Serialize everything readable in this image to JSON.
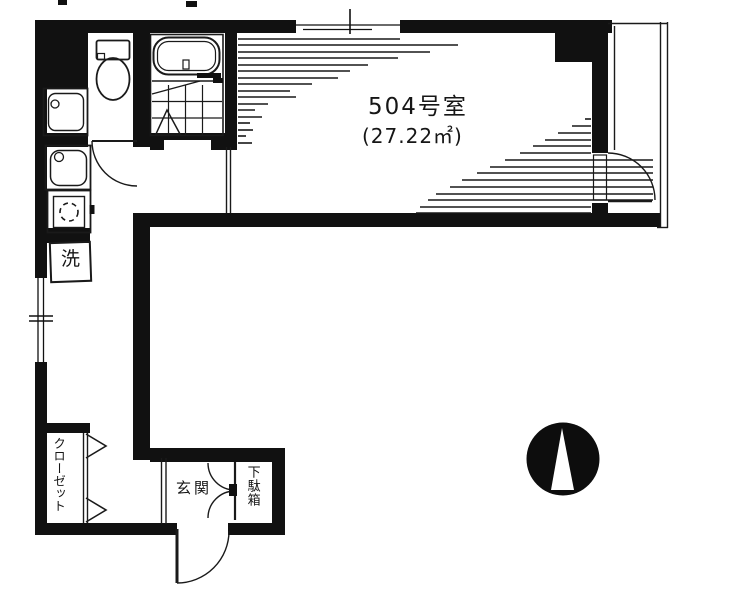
{
  "plan": {
    "room_number_label": "504号室",
    "room_area_label": "(27.22㎡)",
    "entrance_label": "玄関",
    "shoe_cabinet_label": "下駄箱",
    "closet_label": "クローゼット",
    "washer_label": "洗"
  },
  "icons": {
    "compass": "north-arrow-compass",
    "toilet": "toilet-fixture",
    "bathtub": "bathtub-fixture",
    "sink": "kitchen-sink-fixture",
    "stove": "stove-fixture",
    "washbasin": "washbasin-fixture"
  },
  "colors": {
    "ink": "#111111",
    "background": "#ffffff"
  }
}
